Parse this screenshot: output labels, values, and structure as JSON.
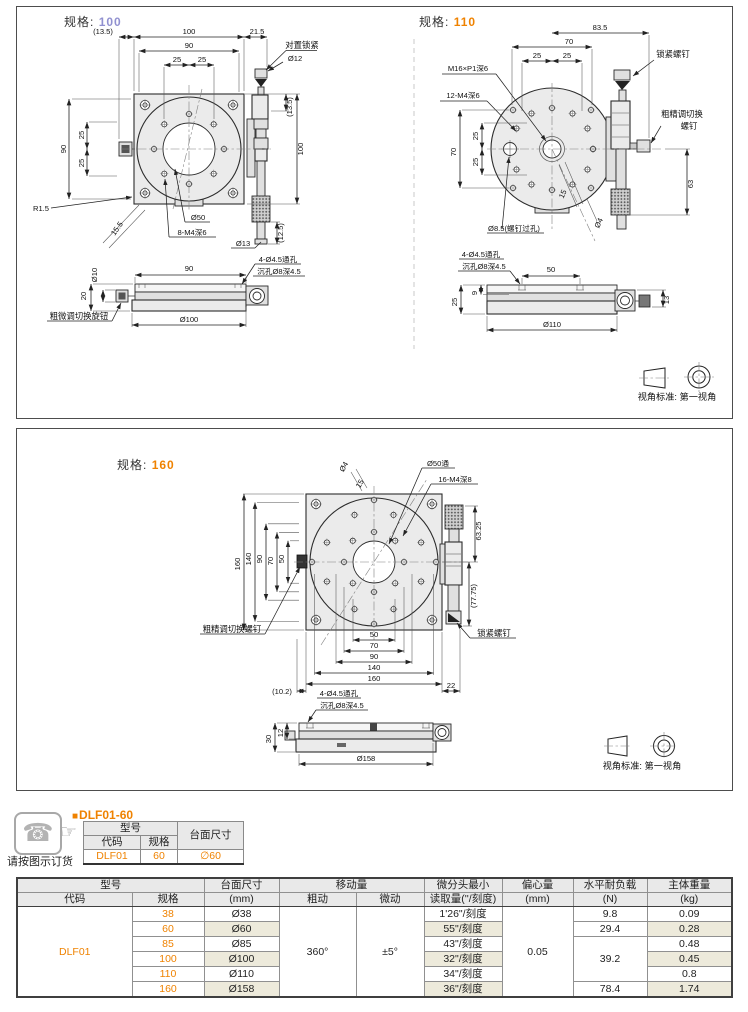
{
  "colors": {
    "accent": "#ef8200",
    "purple": "#9191d0",
    "zebra": "#edeadb"
  },
  "p100": {
    "spec_label": "规格:",
    "spec_value": "100",
    "lock_label": "对置锁紧",
    "d13_5": "(13.5)",
    "d100": "100",
    "d21_5": "21.5",
    "d90": "90",
    "d25": "25",
    "dia12": "Ø12",
    "d12_5": "(12.5)",
    "dia13": "Ø13",
    "r1_5": "R1.5",
    "d15_5": "15.5",
    "dia50": "Ø50",
    "m4": "8-M4深6",
    "dia10": "Ø10",
    "d20": "20",
    "hole1": "4-Ø4.5通孔",
    "hole2": "沉孔Ø8深4.5",
    "dia100": "Ø100",
    "knob": "粗微调切换旋钮"
  },
  "p110": {
    "spec_label": "规格:",
    "spec_value": "110",
    "d83_5": "83.5",
    "d70": "70",
    "d25": "25",
    "d63": "63",
    "m16": "M16×P1深6",
    "m4": "12-M4深6",
    "lock": "锁紧螺钉",
    "adj1": "粗精调切换",
    "adj2": "螺钉",
    "dia8_5": "Ø8.5(螺钉过孔)",
    "d15": "15",
    "dia4": "Ø4",
    "hole1": "4-Ø4.5通孔",
    "hole2": "沉孔Ø8深4.5",
    "d50": "50",
    "d25s": "25",
    "d9": "9",
    "d13": "13",
    "dia110": "Ø110"
  },
  "p160": {
    "spec_label": "规格:",
    "spec_value": "160",
    "dia4": "Ø4",
    "d15": "15",
    "dia50": "Ø50通",
    "m4": "16-M4深8",
    "d160": "160",
    "d140": "140",
    "d90": "90",
    "d70": "70",
    "d50": "50",
    "d63_25": "63.25",
    "d77_75": "(77.75)",
    "lock": "锁紧螺钉",
    "adj": "粗精调切换螺钉",
    "d10_2": "(10.2)",
    "d22": "22",
    "hole1": "4-Ø4.5通孔",
    "hole2": "沉孔Ø8深4.5",
    "d12": "12",
    "d30": "30",
    "dia158": "Ø158"
  },
  "view_standard": "视角标准: 第一视角",
  "order": {
    "caption": "请按图示订货",
    "bullet": "■",
    "model": "DLF01-60",
    "col_model": "型号",
    "col_code": "代码",
    "col_spec": "规格",
    "col_size": "台面尺寸",
    "code": "DLF01",
    "spec": "60",
    "size": "∅60",
    "phone_icon": "☎",
    "hand_icon": "☞"
  },
  "spec_table": {
    "headers": {
      "model": "型号",
      "code": "代码",
      "spec": "规格",
      "size1": "台面尺寸",
      "size2": "(mm)",
      "travel": "移动量",
      "coarse": "粗动",
      "fine": "微动",
      "micro1": "微分头最小",
      "micro2": "读取量(''/刻度)",
      "ecc1": "偏心量",
      "ecc2": "(mm)",
      "load1": "水平耐负载",
      "load2": "(N)",
      "weight1": "主体重量",
      "weight2": "(kg)"
    },
    "code": "DLF01",
    "coarse": "360°",
    "fine": "±5°",
    "ecc": "0.05",
    "rows": [
      {
        "spec": "38",
        "size": "Ø38",
        "reading": "1'26\"/刻度",
        "weight": "0.09"
      },
      {
        "spec": "60",
        "size": "Ø60",
        "reading": "55\"/刻度",
        "weight": "0.28"
      },
      {
        "spec": "85",
        "size": "Ø85",
        "reading": "43\"/刻度",
        "weight": "0.48"
      },
      {
        "spec": "100",
        "size": "Ø100",
        "reading": "32\"/刻度",
        "weight": "0.45"
      },
      {
        "spec": "110",
        "size": "Ø110",
        "reading": "34\"/刻度",
        "weight": "0.8"
      },
      {
        "spec": "160",
        "size": "Ø158",
        "reading": "36\"/刻度",
        "weight": "1.74"
      }
    ],
    "loads": {
      "l38": "9.8",
      "l60": "29.4",
      "l85_110": "39.2",
      "l160": "78.4"
    }
  }
}
